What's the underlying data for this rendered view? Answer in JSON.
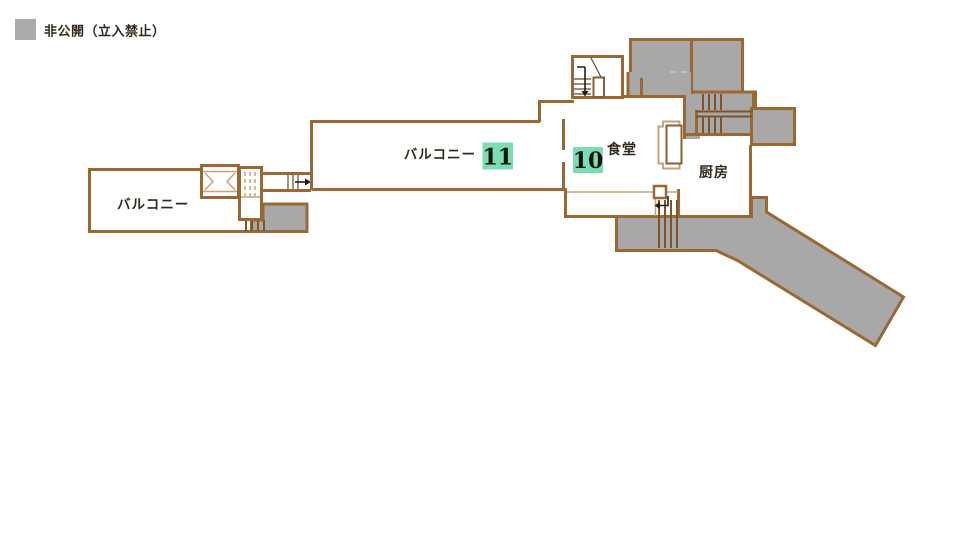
{
  "legend": {
    "label": "非公開（立入禁止）",
    "swatch_color": "#ababab"
  },
  "rooms": {
    "balcony_left": "バルコニー",
    "balcony_main": "バルコニー",
    "dining": "食堂",
    "kitchen": "厨房"
  },
  "badges": {
    "balcony": {
      "number": "11"
    },
    "dining": {
      "number": "10"
    },
    "color": "#7bdeb2"
  },
  "colors": {
    "wall": "#9c6831",
    "restricted_fill": "#a8a8a8",
    "detail_tan": "#caa179",
    "label_text": "#332a1d"
  }
}
